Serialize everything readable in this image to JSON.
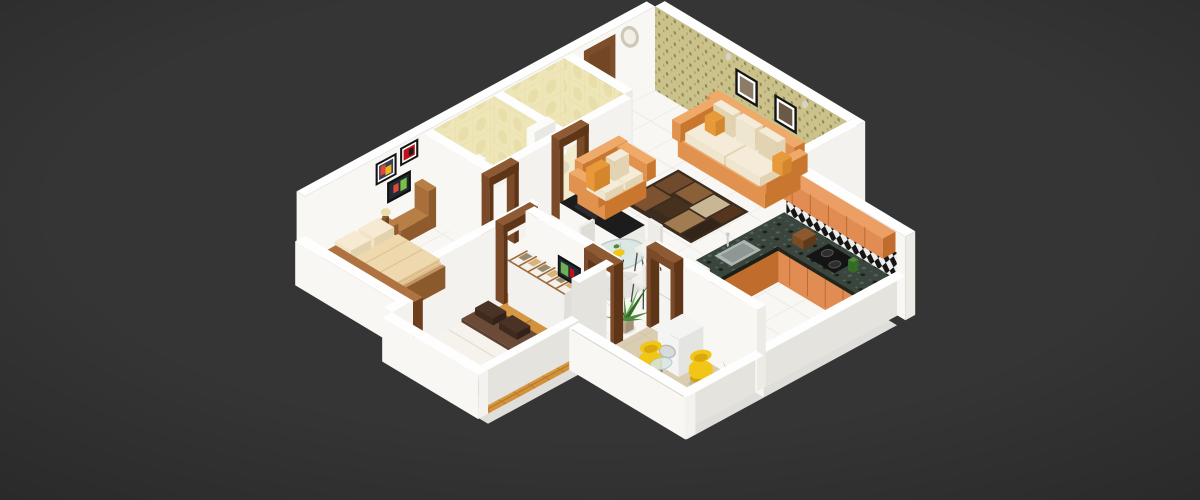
{
  "scene": {
    "type": "3d-isometric-floor-plan",
    "description": "3D isometric render of a 2 BHK apartment floor plan on a dark gray background",
    "background": "#353535"
  },
  "rooms": [
    {
      "name": "living-room"
    },
    {
      "name": "kitchen"
    },
    {
      "name": "dining-area"
    },
    {
      "name": "bathroom-1"
    },
    {
      "name": "bathroom-2"
    },
    {
      "name": "hallway"
    },
    {
      "name": "bedroom-1"
    },
    {
      "name": "bedroom-2"
    },
    {
      "name": "balcony"
    }
  ],
  "furniture": [
    {
      "name": "wall-clock",
      "room": "living-room"
    },
    {
      "name": "main-entrance-door",
      "room": "living-room"
    },
    {
      "name": "wallpaper-accent-wall",
      "room": "living-room"
    },
    {
      "name": "living-picture-frames",
      "room": "living-room",
      "count": 2
    },
    {
      "name": "three-seater-sofa",
      "room": "living-room"
    },
    {
      "name": "two-seater-sofa",
      "room": "living-room"
    },
    {
      "name": "area-rug",
      "room": "living-room"
    },
    {
      "name": "toilet",
      "room": "bathroom-1"
    },
    {
      "name": "toilet",
      "room": "bathroom-2"
    },
    {
      "name": "utility-counter",
      "room": "hallway"
    },
    {
      "name": "door-frames",
      "room": "hallway",
      "count": 5
    },
    {
      "name": "tv-cabinet",
      "room": "bedroom-1"
    },
    {
      "name": "television",
      "room": "bedroom-1"
    },
    {
      "name": "picture-frames",
      "room": "bedroom-1",
      "count": 2
    },
    {
      "name": "nightstand-with-lamp",
      "room": "bedroom-1"
    },
    {
      "name": "double-bed",
      "room": "bedroom-1"
    },
    {
      "name": "wall-shelf-unit",
      "room": "bedroom-1"
    },
    {
      "name": "wardrobe",
      "room": "bedroom-2"
    },
    {
      "name": "television",
      "room": "bedroom-2"
    },
    {
      "name": "double-bed",
      "room": "bedroom-2"
    },
    {
      "name": "dining-table",
      "room": "dining-area"
    },
    {
      "name": "dining-chairs",
      "room": "dining-area",
      "count": 4
    },
    {
      "name": "houseplant",
      "room": "dining-area"
    },
    {
      "name": "kitchen-counter",
      "room": "kitchen"
    },
    {
      "name": "gas-stove",
      "room": "kitchen"
    },
    {
      "name": "kitchen-sink",
      "room": "kitchen"
    },
    {
      "name": "overhead-cabinets",
      "room": "kitchen"
    },
    {
      "name": "checkered-backsplash",
      "room": "kitchen"
    },
    {
      "name": "refrigerator",
      "room": "kitchen"
    },
    {
      "name": "washing-machine",
      "room": "balcony"
    },
    {
      "name": "tub-chairs",
      "room": "balcony",
      "count": 2
    },
    {
      "name": "coffee-table",
      "room": "balcony"
    },
    {
      "name": "houseplant",
      "room": "balcony"
    },
    {
      "name": "railing-wall",
      "room": "balcony"
    }
  ],
  "palette": {
    "background": "#353535",
    "wall_top": "#FEFEFE",
    "wall_bright": "#F8F7F3",
    "wall_mid": "#F3F2EE",
    "wall_shade": "#ECEBE5",
    "wall_dim": "#E4E3DD",
    "slab": "#DFDEDA",
    "bath_floor": "#F2ECCF",
    "door_wood": "#7C4E2B",
    "door_wood_dark": "#6A3F20",
    "door_knob": "#E8D5A2",
    "frame_wood": "#7B4A28",
    "frame_wood_top": "#8D5A33",
    "frame_wood_dark": "#5E3617",
    "sofa_orange": "#E1924F",
    "sofa_orange_top": "#EFA968",
    "sofa_orange_dark": "#C9772F",
    "cushion": "#EFE6CF",
    "cushion_dark": "#E2D3B2",
    "pillow_accent": "#E89A3B",
    "rug_base": "#3C2B1F",
    "rug_patches": [
      "#6F4A2C",
      "#8A6038",
      "#C9B695",
      "#55351E",
      "#7C5230",
      "#46311F",
      "#A07C50",
      "#33241A"
    ],
    "bed_frame": "#C19462",
    "bed_frame_dark": "#9C6434",
    "bedding": "#E9D2A8",
    "bedding_dark": "#DDBE8C",
    "pillow_cream": "#F1E3C6",
    "mattress": "#F1EDE5",
    "blanket": "#5E4030",
    "pillow_dark": "#3F2A1E",
    "bed2_frame": "#A9743E",
    "wardrobe_wood": "#A06A38",
    "wardrobe_white": "#F2F1ED",
    "cloth1": "#D9B37E",
    "cloth2": "#9A8A6A",
    "shelf_wood": "#9C6434",
    "shelf_wood_top": "#AE7340",
    "shelf_wood_dark": "#6E3F1C",
    "shelf_fill": "#C8A070",
    "shelf_item": "#50301A",
    "tv_cab": "#B77F45",
    "tv_cab_dark": "#A96F3A",
    "tv_black": "#111111",
    "tv_screen": "#1E2A36",
    "art_red": "#C1121C",
    "art_multi": [
      "#E2483A",
      "#3E6FB0",
      "#E8B61F",
      "#7AC043"
    ],
    "cabinet_orange": "#E08C52",
    "cabinet_orange_top": "#EC9F64",
    "cabinet_orange_dark": "#C06C2C",
    "granite_edge": "#20261F",
    "steel": "#AEB6B4",
    "steel_dark": "#8E9794",
    "chair_yellow": "#F2C616",
    "chair_yellow_dark": "#CEA50A",
    "chair_yellow_deep": "#D9A90B",
    "glass": "#D9E6E3",
    "glass_rim": "#AFC4C0",
    "plant_green": "#4C8A3C",
    "plant_light": "#6FAE54",
    "plant_dark": "#356B28",
    "pot": "#B8A890",
    "white_goods": "#F4F4F2",
    "white_goods_side": "#E4E4E0",
    "toilet": "#FBFBF9",
    "toilet_shade": "#E9E8E3",
    "counter_black": "#1C1C1C",
    "clock_ring": "#CFC8B8",
    "clock_face": "#F2EFE6",
    "lamp_shade": "#EADFA8",
    "lamp_base": "#8A5A2E",
    "chair_white": "#EDECE8",
    "chair_leg": "#4A4A4A"
  }
}
